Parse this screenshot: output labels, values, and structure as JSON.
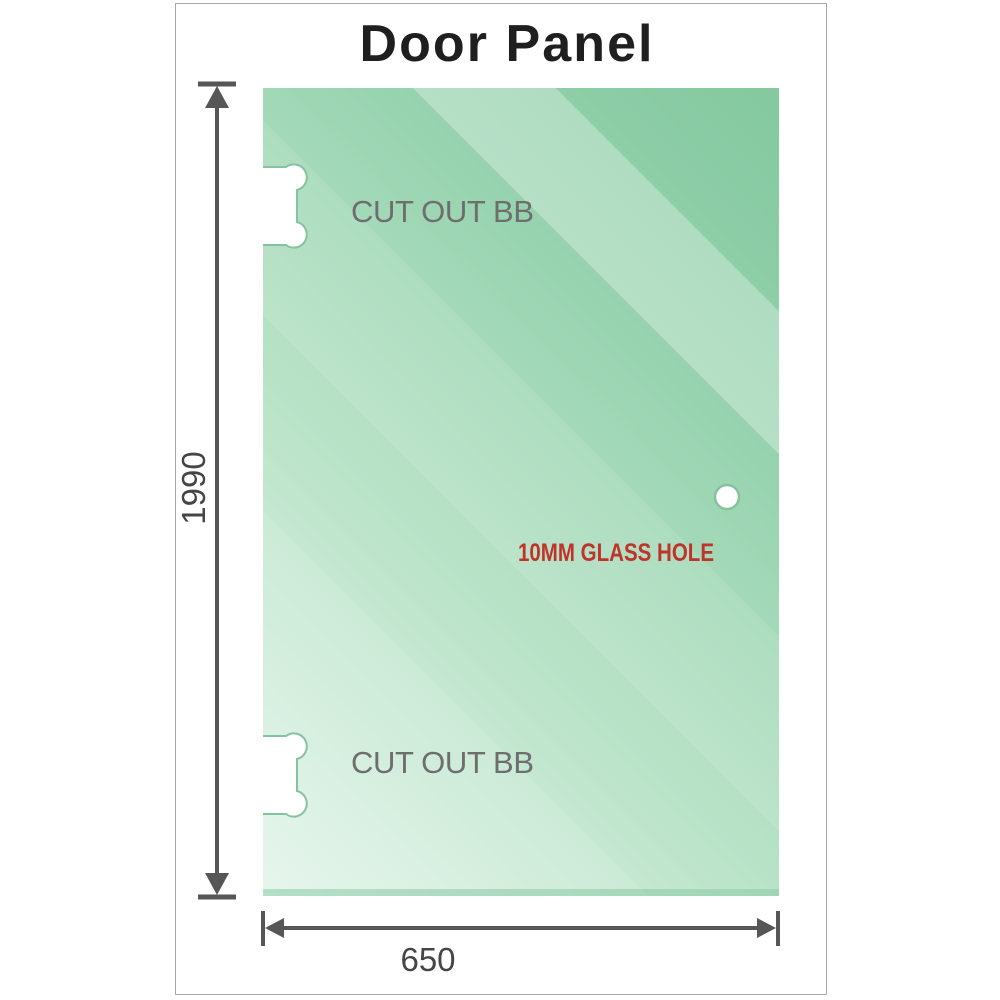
{
  "title": "Door Panel",
  "diagram": {
    "cutouts": [
      {
        "position": "top",
        "label": "CUT OUT BB"
      },
      {
        "position": "bottom",
        "label": "CUT OUT BB"
      }
    ],
    "glass_hole": {
      "label": "10MM GLASS HOLE"
    },
    "dimensions": {
      "height": "1990",
      "width": "650"
    }
  },
  "colors": {
    "glass_light": "#e4f5eb",
    "glass_mid": "#b7e2c6",
    "glass_deep": "#97d3af",
    "glass_dark": "#83c89f",
    "cutout_outline": "#84c2a0",
    "frame_border": "#a8a8a8",
    "dimension_line": "#565656",
    "dimension_text": "#454545",
    "label_gray": "#6e6e6e",
    "hole_label_red": "#c0332a",
    "title_text": "#1f1f1f"
  }
}
